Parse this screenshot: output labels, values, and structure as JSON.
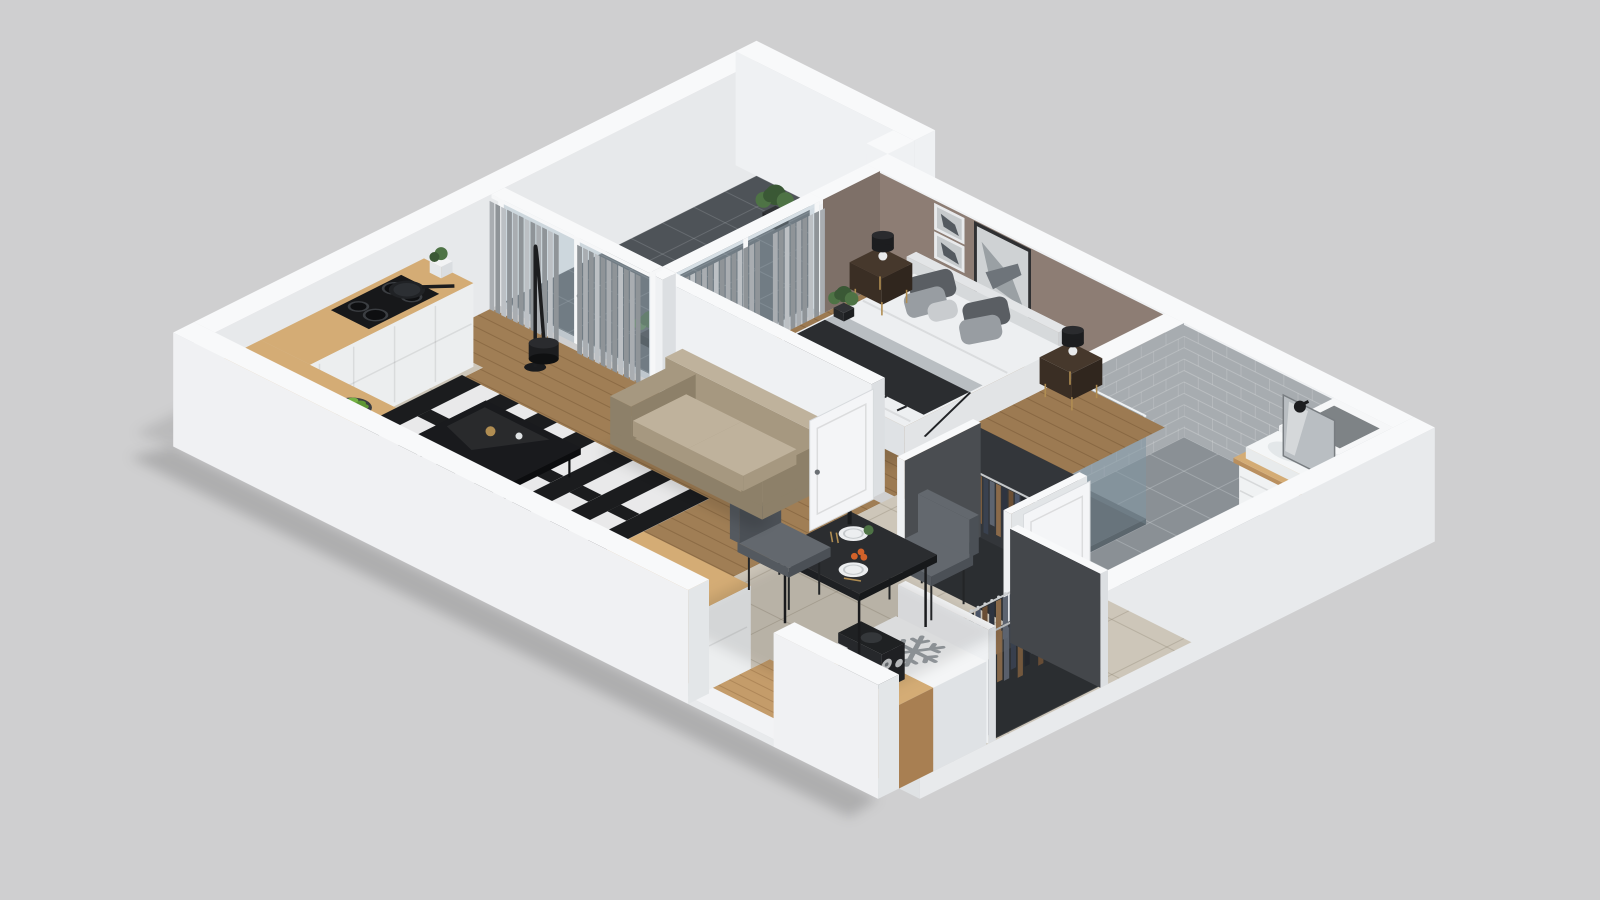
{
  "meta": {
    "title": "3D isometric dollhouse render of a one-bedroom apartment floor plan",
    "view": "isometric cutaway, walls cut at uniform height, plain gray backdrop",
    "background": "#cfcfd0"
  },
  "icons": {
    "snowflake": {
      "meaning": "refrigerator location marker on cabinet top",
      "color": "#9ba0a5"
    }
  },
  "rooms": [
    {
      "id": "bedroom",
      "label": "Bedroom",
      "furniture": [
        "double-bed",
        "headboard",
        "throw-blanket",
        "pillows",
        "nightstand-left",
        "nightstand-right",
        "table-lamp-left",
        "table-lamp-right",
        "wall-art-small",
        "wall-art-large",
        "curtains",
        "potted-plant",
        "window-wall"
      ]
    },
    {
      "id": "bathroom",
      "label": "Bathroom",
      "furniture": [
        "walk-in-shower",
        "glass-screen",
        "sink-vanity",
        "basin",
        "mirror",
        "wall-lamp",
        "washing-machine",
        "ventilation-duct",
        "bathroom-door"
      ]
    },
    {
      "id": "living-room",
      "label": "Living room",
      "furniture": [
        "loveseat-sofa",
        "striped-rug",
        "coffee-table",
        "arc-floor-lamp",
        "sheer-curtains",
        "passage-door"
      ]
    },
    {
      "id": "kitchen",
      "label": "Kitchen",
      "furniture": [
        "l-shaped-counter",
        "induction-cooktop",
        "frying-pan",
        "kitchen-sink",
        "faucet",
        "fruit-bowl",
        "kettle",
        "small-plant"
      ]
    },
    {
      "id": "dining-area",
      "label": "Dining area",
      "furniture": [
        "dining-table",
        "dining-chair-north",
        "dining-chair-south",
        "plates",
        "tomatoes",
        "bottle",
        "table-plant"
      ]
    },
    {
      "id": "hallway",
      "label": "Hallway",
      "furniture": [
        "open-wardrobe-a",
        "open-wardrobe-b",
        "hanging-clothes",
        "fridge-cabinet",
        "coffee-machine",
        "cups",
        "entry-threshold"
      ]
    },
    {
      "id": "balcony",
      "label": "Balcony",
      "furniture": [
        "glass-door-wall",
        "balcony-plant-north",
        "balcony-plant-south",
        "dark-tile-floor"
      ]
    }
  ],
  "palette": {
    "bg": "#cfcfd0",
    "wallTop": "#f8f9fa",
    "faceSouth": "#eff1f3",
    "faceEast": "#dcdfe2",
    "faceInner": "#e7e9eb",
    "taupe": "#8d7d74",
    "taupeDark": "#7e7068",
    "tileWall": "#a7acb0",
    "bathFloor": "#8a9095",
    "ductInner": "#7e8386",
    "woodBed": "#9c7a52",
    "woodLiving": "#a07e55",
    "woodCounter": "#d4ac75",
    "woodEntry": "#c49c6a",
    "tileKitchen": "#cdc6b9",
    "balconyFloor": "#4e5358",
    "glass": "rgba(168,188,200,0.40)",
    "frameWhite": "#f6f7f8",
    "curtainA": "#a9adb1",
    "curtainB": "#8f9498",
    "curtainC": "#bcc0c4",
    "rugBlack": "#1b1c1e",
    "rugWhite": "#e9e9ea",
    "sofaBase": "#a69880",
    "sofaCushion": "#bfb29c",
    "sofaDark": "#8d8069",
    "throwDark": "#2b2d30",
    "linen": "#edeff1",
    "linenSide": "#dfe2e5",
    "pillowDark": "#5a5e63",
    "pillowMid": "#989da2",
    "pillowLight": "#c9cccf",
    "headboard": "#e3e5e7",
    "nightstand": "#46382c",
    "nightstandDark": "#3a2e24",
    "gold": "#b08d52",
    "lampBlack": "#1c1d1f",
    "mirror": "#b9bec2",
    "vanityWhite": "#f0f2f3",
    "washerWhite": "#eff1f3",
    "washerDoor": "#2c3035",
    "steel": "#c8cccf",
    "water": "#82b3c6",
    "plantGreen": "#4e7345",
    "plantDark": "#3a5835",
    "potDark": "#26282a",
    "appleGreen": "#74b043",
    "appleDark": "#5e9635",
    "orange": "#d2622a",
    "tableDark": "#2b2d30",
    "chairGray": "#63686e",
    "chairDark": "#54595f",
    "doorWhite": "#f4f5f7",
    "snowflake": "#9ba0a5",
    "cooktop": "#17181a",
    "burner": "#3b3e42",
    "showerTray": "#5a5f64"
  },
  "clothesColors": [
    "#2e3440",
    "#6b4f35",
    "#4c566a",
    "#23262b",
    "#7a5c3e",
    "#39414f",
    "#5d6470",
    "#8a6a4a"
  ],
  "curtainColors": [
    "#a9adb1",
    "#8f9498",
    "#bcc0c4"
  ]
}
